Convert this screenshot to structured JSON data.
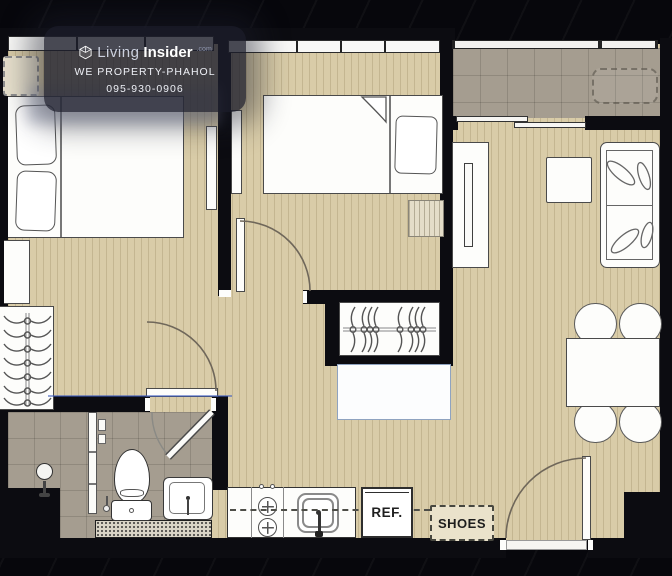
{
  "watermark": {
    "brand_prefix": "Living",
    "brand_suffix": "Insider",
    "brand_tld": ".com",
    "agency": "WE PROPERTY-PHAHOL",
    "phone": "095-930-0906"
  },
  "labels": {
    "refrigerator": "REF.",
    "shoes": "SHOES"
  },
  "colors": {
    "wood_floor": "#d9cca8",
    "tile_floor": "#a59d90",
    "wall": "#0c0c11",
    "furniture_outline": "#4a4a4a",
    "watermark_overlay": "#1b1d2b",
    "accent_line": "#3d5bbf"
  }
}
